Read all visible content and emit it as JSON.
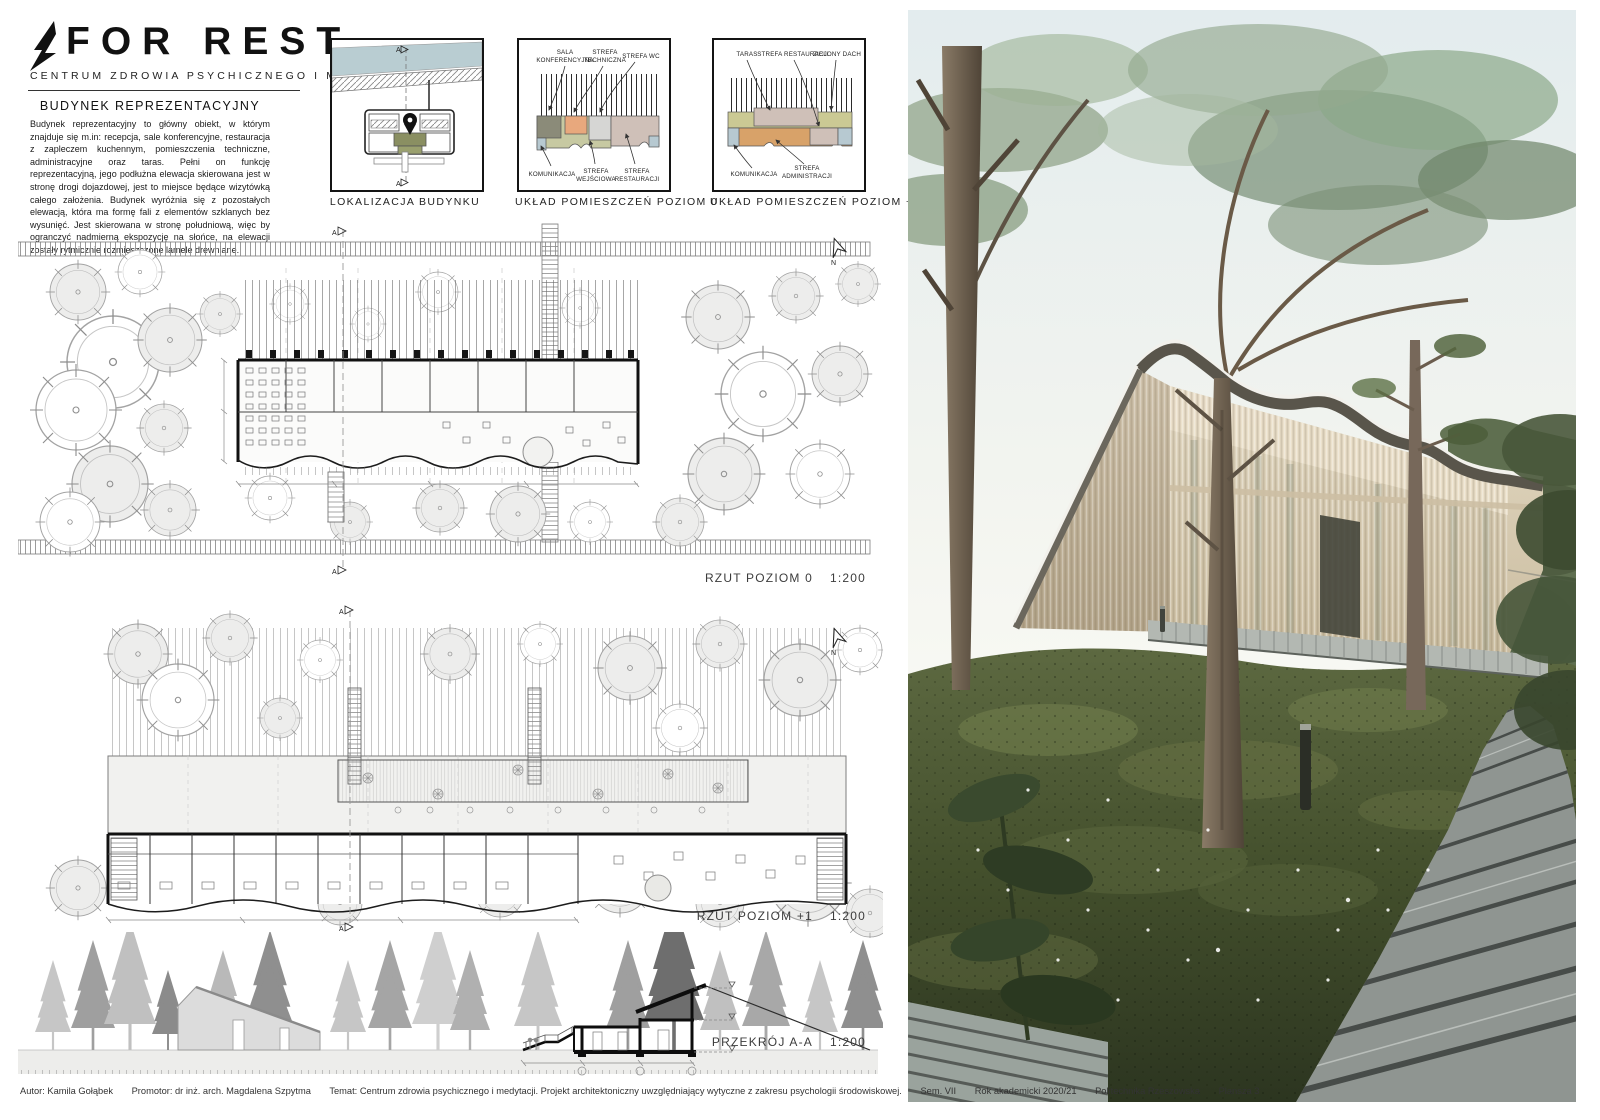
{
  "header": {
    "logo_title": "FOR REST",
    "subtitle": "CENTRUM ZDROWIA PSYCHICZNEGO I MEDYTACJI"
  },
  "description": {
    "heading": "BUDYNEK REPREZENTACYJNY",
    "body": "Budynek reprezentacyjny to główny obiekt, w którym znajduje się m.in: recepcja, sale konferencyjne, restauracja z zapleczem kuchennym, pomieszczenia techniczne, administracyjne oraz taras. Pełni on funkcję reprezentacyjną, jego podłużna elewacja skierowana jest w stronę drogi dojazdowej, jest to miejsce będące wizytówką całego założenia. Budynek wyróżnia się z pozostałych elewacją, która ma formę fali z elementów szklanych bez wysunięć. Jest skierowana w stronę południową, więc by ogranczyć nadmierną ekspozycję na słońce, na elewacji zostały rytmicznie rozmieszczone lamele drewniane."
  },
  "diagrams": [
    {
      "caption": "LOKALIZACJA BUDYNKU"
    },
    {
      "caption": "UKŁAD POMIESZCZEŃ POZIOM 0",
      "top": [
        [
          "SALA",
          "KONFERENCYJNA"
        ],
        [
          "STREFA",
          "TECHNICZNA"
        ],
        [
          "STREFA WC"
        ]
      ],
      "bottom": [
        [
          "KOMUNIKACJA"
        ],
        [
          "STREFA",
          "WEJŚCIOWA"
        ],
        [
          "STREFA",
          "RESTAURACJI"
        ]
      ]
    },
    {
      "caption": "UKŁAD POMIESZCZEŃ POZIOM +1",
      "top": [
        [
          "TARAS"
        ],
        [
          "STREFA RESTAURACJI"
        ],
        [
          "ZIELONY DACH"
        ]
      ],
      "bottom": [
        [
          "KOMUNIKACJA"
        ],
        [
          "STREFA",
          "ADMINISTRACJI"
        ]
      ]
    }
  ],
  "zone_colors": {
    "water": "#b9cdd2",
    "komunikacja": "#b7c9d1",
    "sala_konferencyjna": "#8b8b79",
    "strefa_techniczna": "#e8a87d",
    "strefa_wc": "#d6d6d4",
    "strefa_wejsciowa": "#c7c9a2",
    "strefa_restauracji": "#cfc0b8",
    "zielony_dach": "#cbc994",
    "strefa_administracji": "#d8a269"
  },
  "drawings": {
    "plan0_title": "RZUT POZIOM 0",
    "plan0_scale": "1:200",
    "plan1_title": "RZUT POZIOM +1",
    "plan1_scale": "1:200",
    "section_title": "PRZEKRÓJ A-A",
    "section_scale": "1:200",
    "north": "N",
    "marker": "A"
  },
  "footer": {
    "items": [
      "Autor: Kamila Gołąbek",
      "Promotor: dr inż. arch. Magdalena Szpytma",
      "Temat: Centrum zdrowia psychicznego i medytacji. Projekt architektoniczny uwzględniający wytyczne z zakresu psychologii środowiskowej.",
      "Sem. VII",
      "Rok akademicki 2020/21",
      "Politechnika Rzeszowska",
      "Plansza 3"
    ]
  }
}
